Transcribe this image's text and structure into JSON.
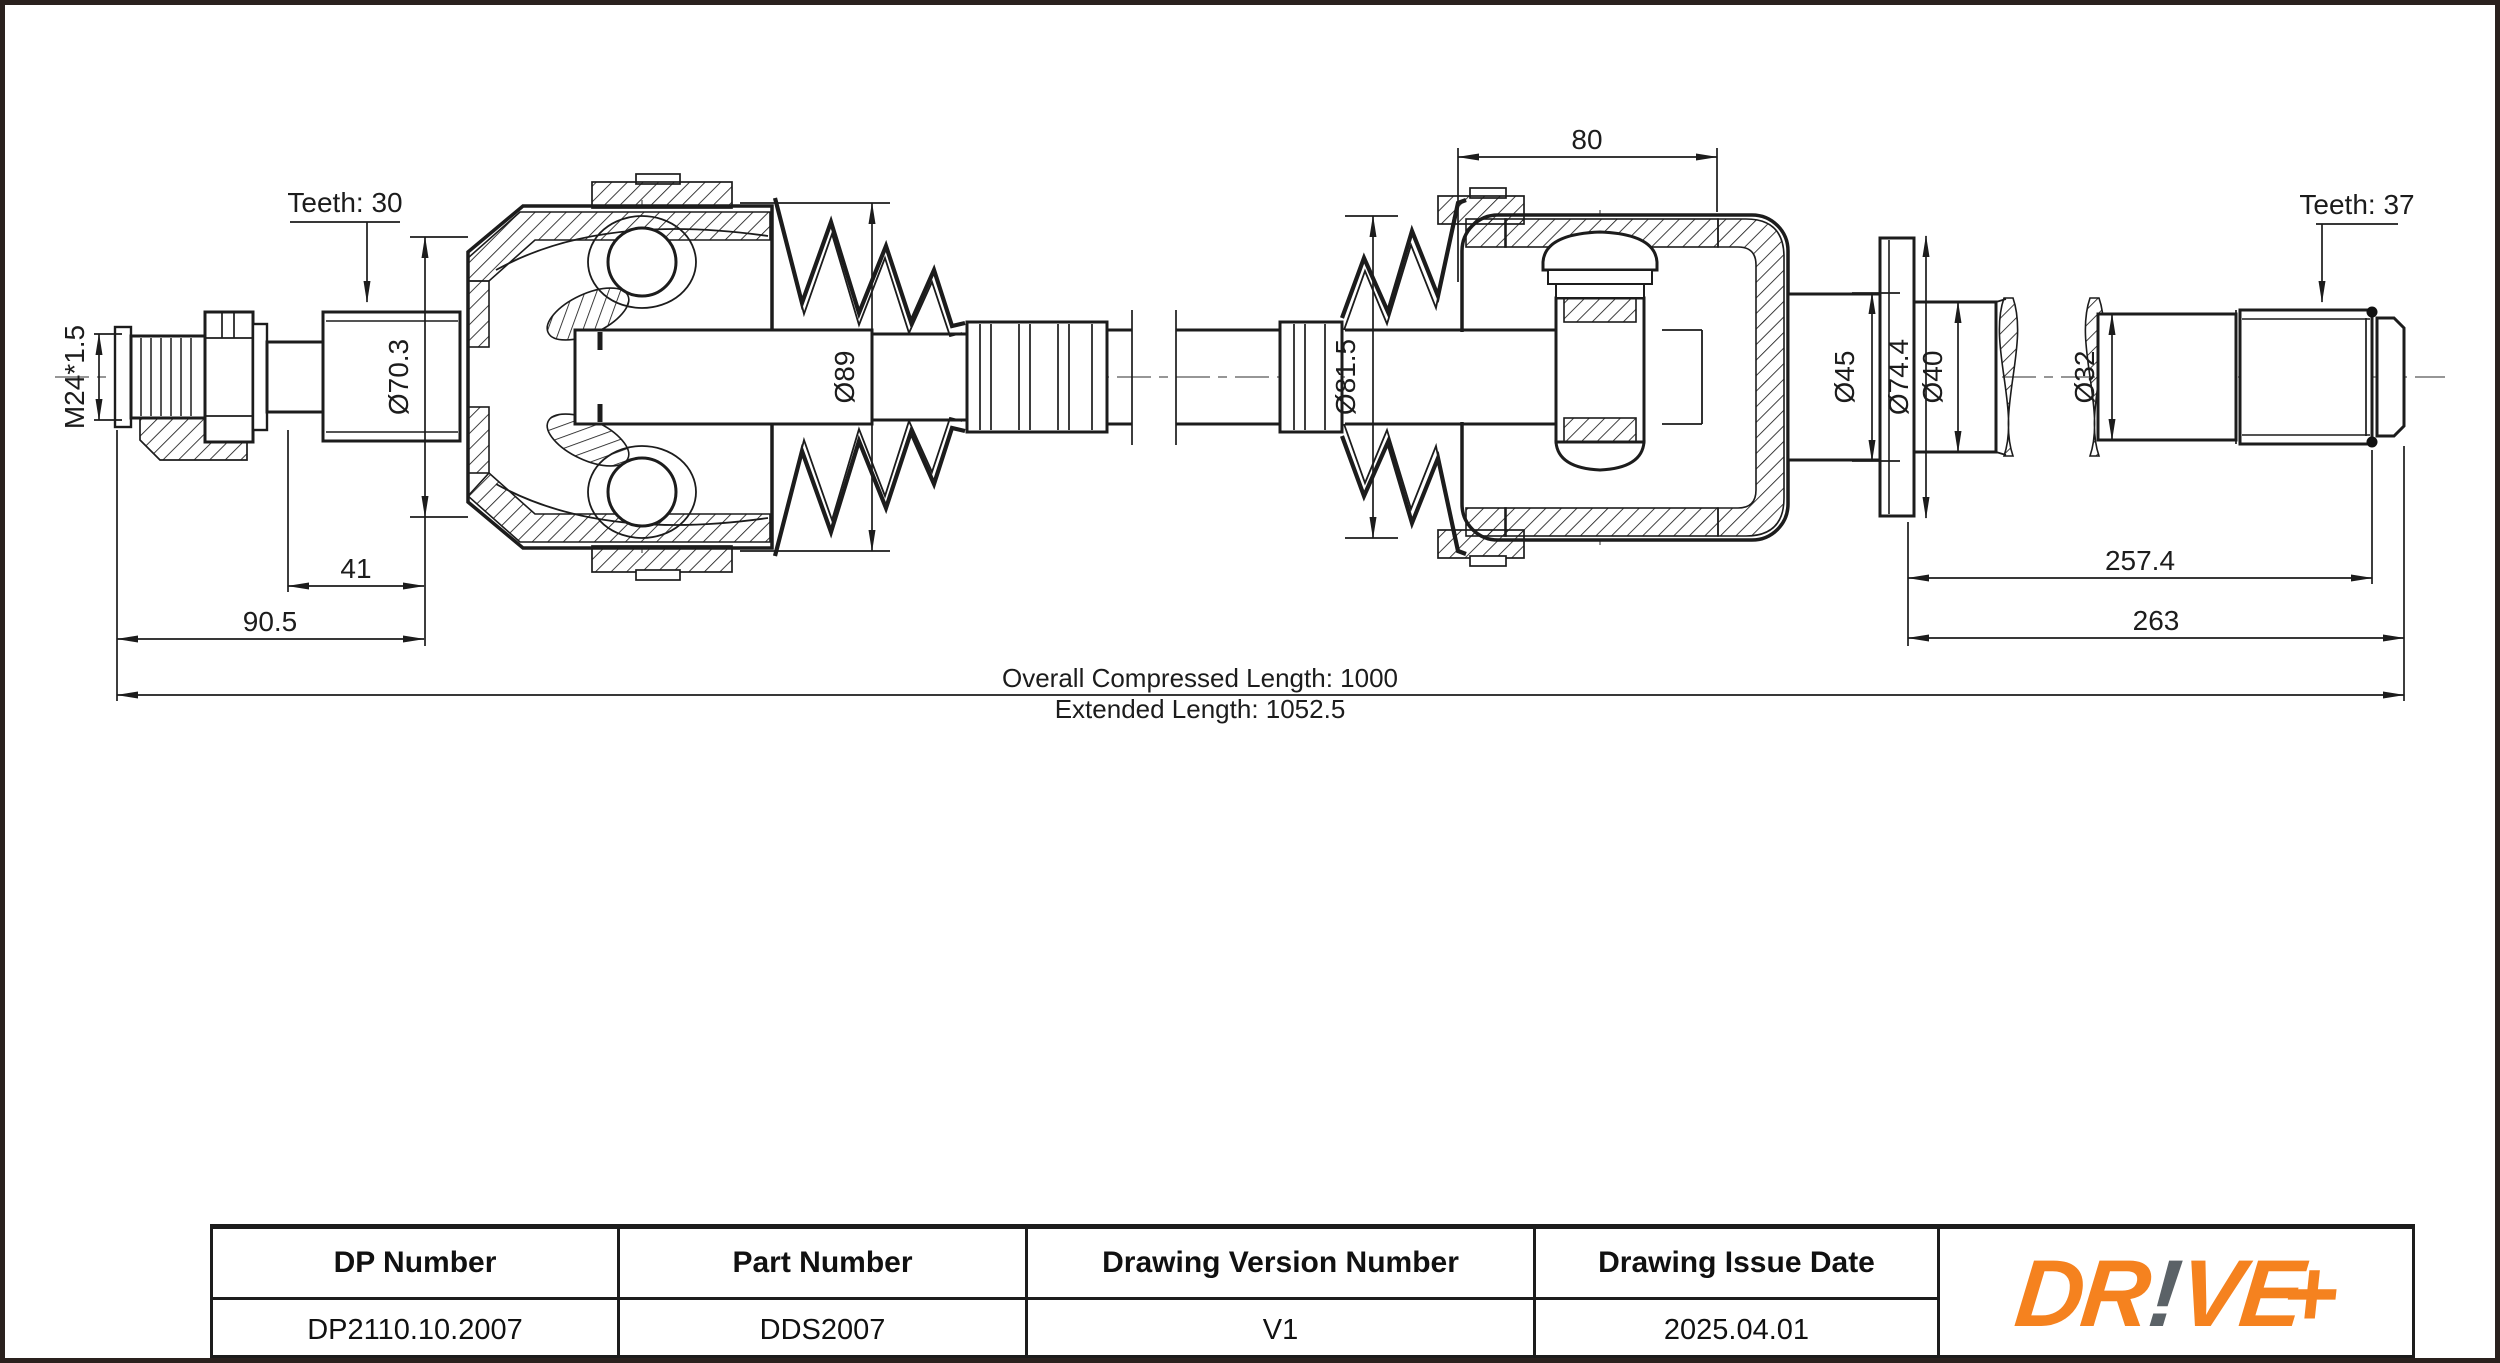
{
  "drawing": {
    "teeth_left_label": "Teeth: 30",
    "teeth_right_label": "Teeth: 37",
    "thread_label": "M24*1.5",
    "dims": {
      "spline_len": "41",
      "stub_len": "90.5",
      "joint_len": "80",
      "shaft_len_1": "257.4",
      "shaft_len_2": "263",
      "dia_70": "Ø70.3",
      "dia_89": "Ø89",
      "dia_81": "Ø81.5",
      "dia_45": "Ø45",
      "dia_74": "Ø74.4",
      "dia_40": "Ø40",
      "dia_32": "Ø32"
    },
    "overall_compressed": "Overall  Compressed  Length: 1000",
    "extended": "Extended  Length: 1052.5"
  },
  "table": {
    "headers": [
      "DP Number",
      "Part Number",
      "Drawing Version Number",
      "Drawing Issue Date"
    ],
    "values": [
      "DP2110.10.2007",
      "DDS2007",
      "V1",
      "2025.04.01"
    ]
  },
  "logo": {
    "part_dr": "DR",
    "part_excl": "!",
    "part_ve": "VE",
    "part_plus": "+",
    "orange": "#F5821F",
    "gray": "#5B6267"
  },
  "colors": {
    "line": "#1c1c1c",
    "centerline": "#969696",
    "frame_border": "#2a211e"
  }
}
